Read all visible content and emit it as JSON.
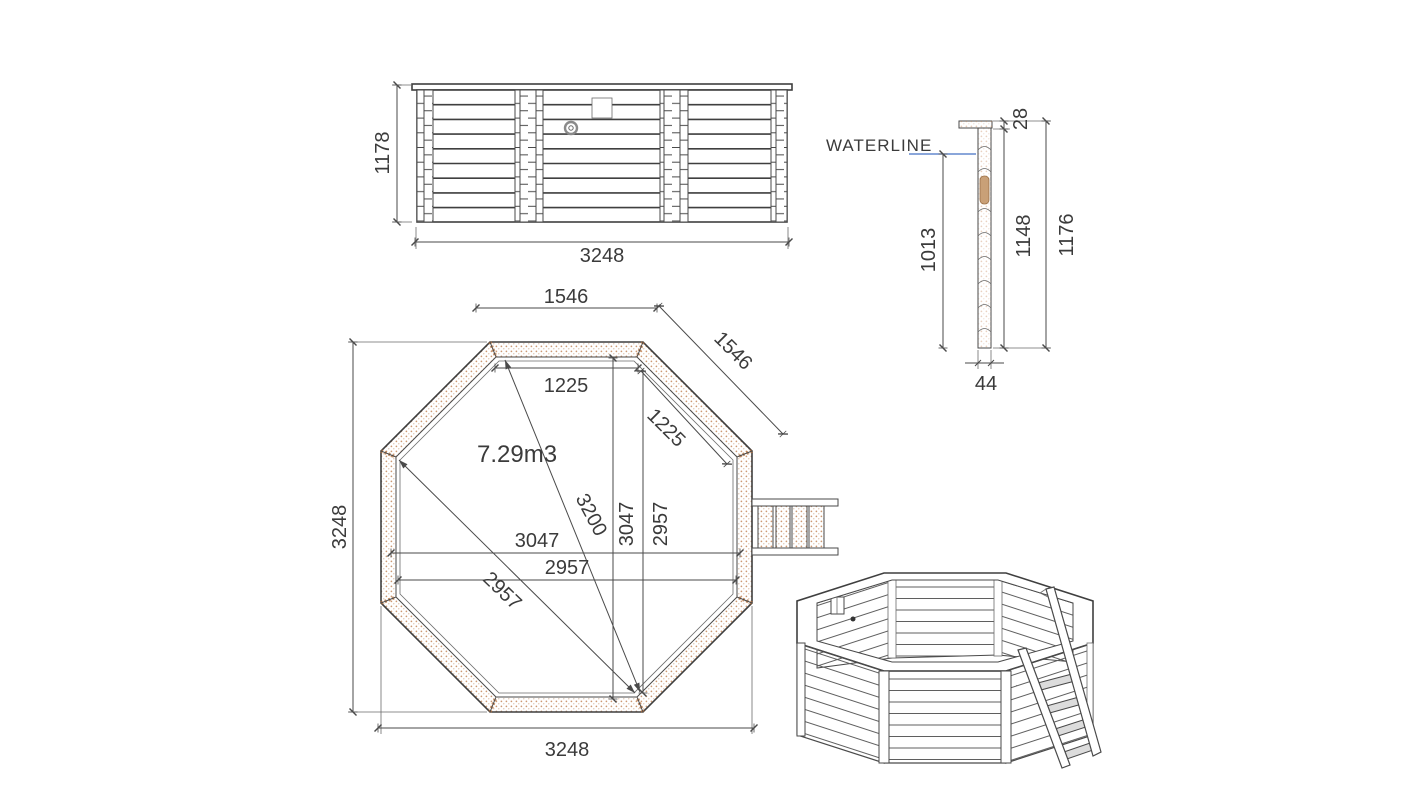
{
  "drawing": {
    "elevation": {
      "height": "1178",
      "width": "3248"
    },
    "section": {
      "waterline_label": "WATERLINE",
      "cap_thickness": "28",
      "waterline_height": "1013",
      "wall_height": "1148",
      "total_height": "1176",
      "wall_thickness": "44"
    },
    "plan": {
      "volume": "7.29m3",
      "top_side": "1546",
      "diagonal_side": "1546",
      "inner_top": "1225",
      "inner_diagonal_side": "1225",
      "long_diagonal": "3200",
      "width_3047": "3047",
      "height_3047": "3047",
      "width_2957": "2957",
      "height_2957": "2957",
      "diagonal_2957": "2957",
      "overall_width": "3248",
      "overall_height": "3248"
    },
    "colors": {
      "line": "#4a4a4a",
      "waterline_blue": "#4472c4",
      "wood_dot": "#c4875a"
    }
  }
}
